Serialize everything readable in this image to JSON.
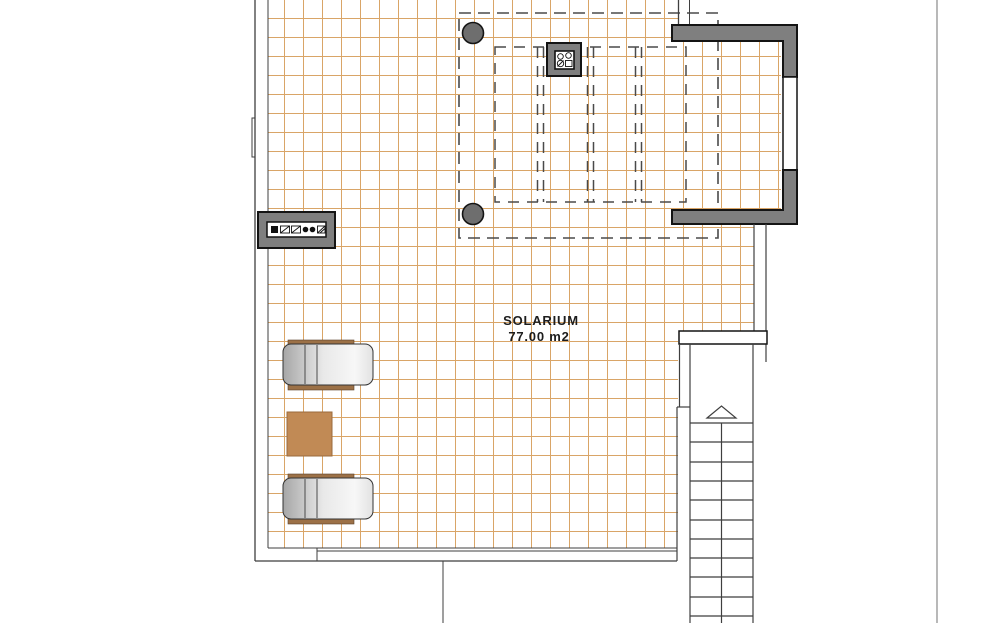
{
  "plan": {
    "type": "floor-plan",
    "level": "roof terrace",
    "room": {
      "name": "SOLARIUM",
      "area": "77.00 m2"
    },
    "furniture": {
      "sun_loungers": 2,
      "side_tables": 1
    },
    "features": [
      "tiled deck grid",
      "pergola dashed outline",
      "roof overhang dashed outline",
      "two structural columns",
      "chimney vent",
      "wall vent legend plate",
      "staircase going up",
      "parapet walls"
    ],
    "stairs": {
      "direction_icon": "up-arrow",
      "treads_visible": 11
    }
  },
  "colors": {
    "background": "#ffffff",
    "grid_line": "#d9a567",
    "outline": "#3f3f3f",
    "boundary_line": "#8a8a8a",
    "dashed_line": "#4a4a4a",
    "wall_fill": "#7f7f7f",
    "wall_edge": "#141414",
    "column_fill": "#6e6e6e",
    "lounger_rail": "#9c7147",
    "lounger_body_dark": "#a6a6a6",
    "lounger_body_light": "#f2f2f2",
    "table_fill": "#c18a55",
    "text": "#1d1d1d"
  }
}
